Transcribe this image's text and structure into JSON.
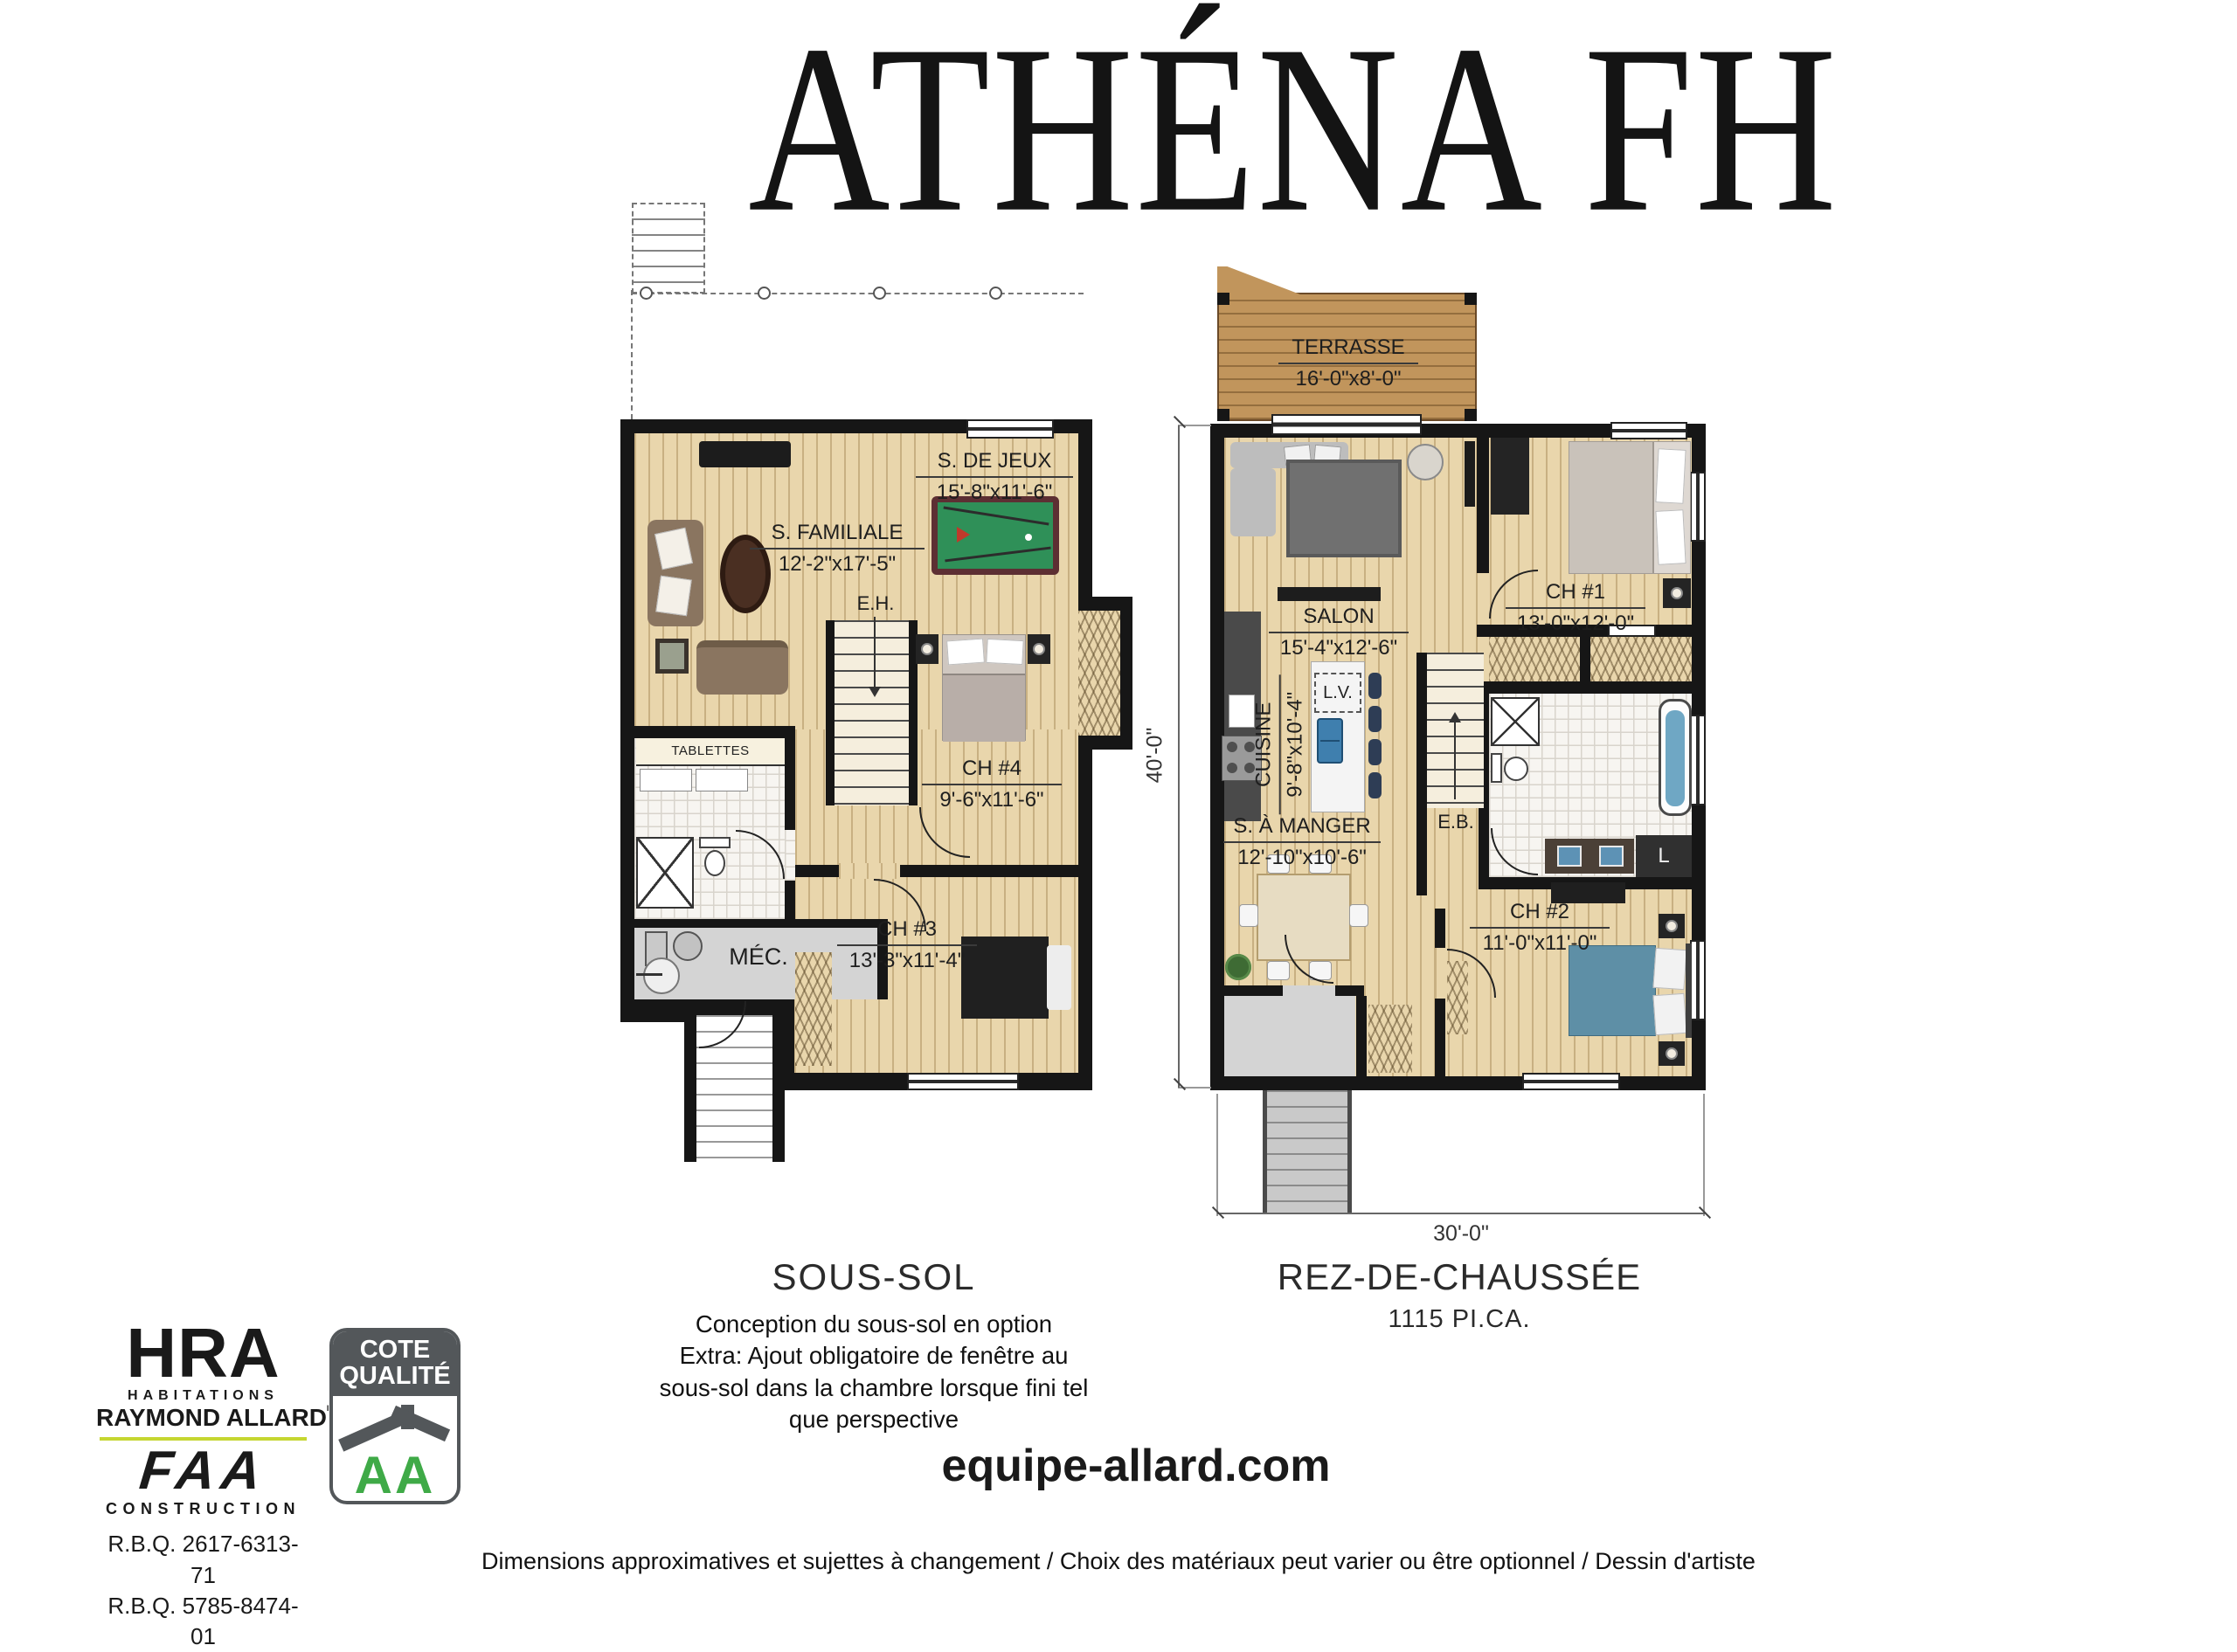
{
  "title": "ATHÉNA FH",
  "basement": {
    "caption": "SOUS-SOL",
    "note_line1": "Conception du sous-sol en option",
    "note_line2": "Extra: Ajout obligatoire de fenêtre au",
    "note_line3": "sous-sol dans la chambre lorsque fini tel",
    "note_line4": "que perspective",
    "rooms": {
      "jeux": {
        "name": "S. DE JEUX",
        "dims": "15'-8\"x11'-6\""
      },
      "familiale": {
        "name": "S. FAMILIALE",
        "dims": "12'-2\"x17'-5\""
      },
      "ch4": {
        "name": "CH #4",
        "dims": "9'-6\"x11'-6\""
      },
      "ch3": {
        "name": "CH #3",
        "dims": "13'-3\"x11'-4\""
      }
    },
    "labels": {
      "mech": "MÉC.",
      "shelves": "TABLETTES",
      "stairs_up": "E.H."
    }
  },
  "ground": {
    "caption": "REZ-DE-CHAUSSÉE",
    "area": "1115 PI.CA.",
    "rooms": {
      "terrasse": {
        "name": "TERRASSE",
        "dims": "16'-0\"x8'-0\""
      },
      "salon": {
        "name": "SALON",
        "dims": "15'-4\"x12'-6\""
      },
      "cuisine": {
        "name": "CUISINE",
        "dims": "9'-8\"x10'-4\""
      },
      "manger": {
        "name": "S. À MANGER",
        "dims": "12'-10\"x10'-6\""
      },
      "ch1": {
        "name": "CH #1",
        "dims": "13'-0\"x12'-0\""
      },
      "ch2": {
        "name": "CH #2",
        "dims": "11'-0\"x11'-0\""
      }
    },
    "labels": {
      "stairs_down": "E.B.",
      "dishwasher": "L.V.",
      "washer": "L"
    },
    "dimensions": {
      "width": "30'-0\"",
      "depth": "40'-0\""
    }
  },
  "footer": {
    "brand": {
      "initials": "HRA",
      "line1": "HABITATIONS",
      "line2": "RAYMOND ALLARD",
      "inc": "INC",
      "faa": "FAA",
      "construction": "CONSTRUCTION",
      "rbq1": "R.B.Q. 2617-6313-71",
      "rbq2": "R.B.Q. 5785-8474-01"
    },
    "badge": {
      "line1": "COTE",
      "line2": "QUALITÉ",
      "grade": "AA"
    },
    "website": "equipe-allard.com",
    "disclaimer": "Dimensions approximatives et sujettes à changement / Choix des matériaux peut varier ou être optionnel / Dessin d'artiste"
  },
  "colors": {
    "wall": "#161616",
    "wood_floor": "#e9d6ac",
    "deck_wood": "#c1955c",
    "pool_felt": "#2f9058",
    "pool_rail": "#5d2f33",
    "tub_blue": "#6fa7c4",
    "bed_blue": "#5e8fa6",
    "badge_gray": "#53575a",
    "badge_green": "#3faa47",
    "brand_lime": "#c5d630"
  }
}
